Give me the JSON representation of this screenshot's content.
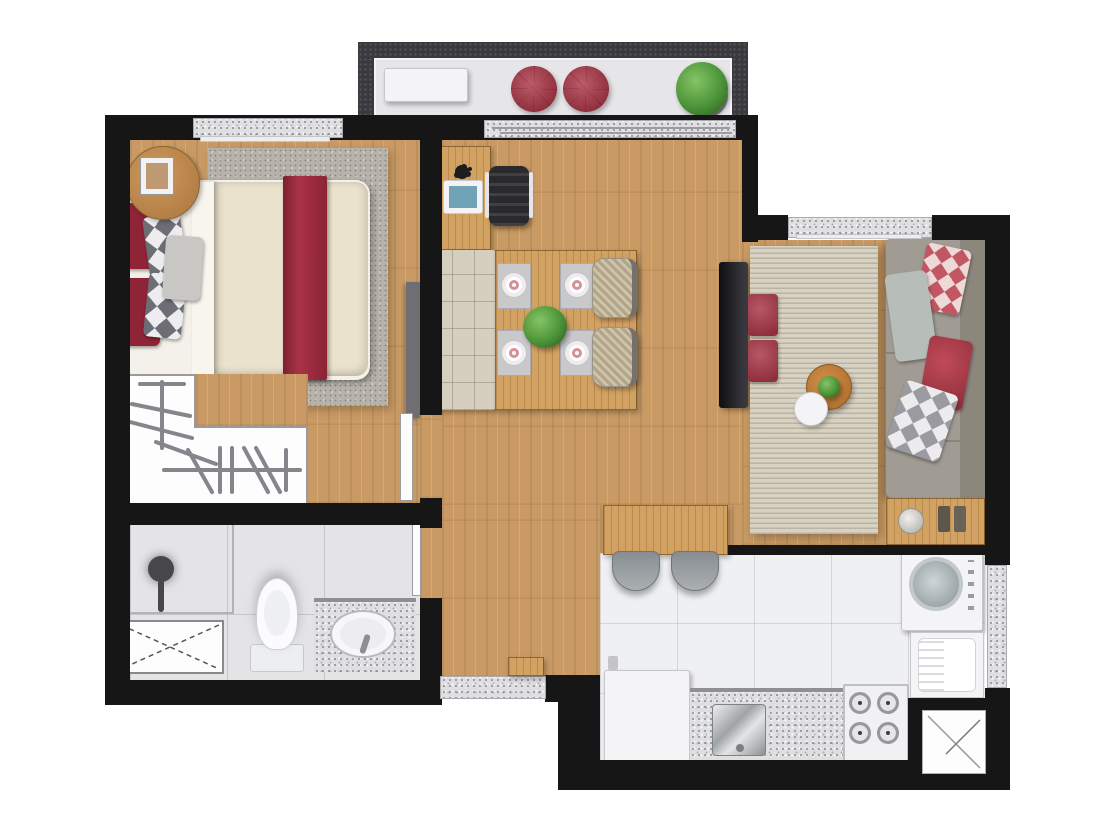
{
  "document_title": "Apartment floor plan — rendered top view",
  "colors": {
    "wall": "#161616",
    "balcony_wall": "#3a3a3e",
    "wood_floor": "#c99a63",
    "wood_furniture": "#d2a263",
    "granite": "#dfdfe2",
    "bath_tile": "#e4e4e7",
    "kitchen_tile": "#eff0f2",
    "bedroom_rug": "#b7b2aa",
    "living_rug": "#d8d2c3",
    "duvet": "#ebe2cd",
    "accent_red": "#9e2b3d",
    "pillow_red": "#8f2436",
    "sofa_gray": "#a19c93",
    "chair_dark": "#2a2a2e",
    "plant_green": "#4c9338",
    "fixture_white": "#f4f4f6",
    "screen_blue": "#6fa3b5"
  },
  "rooms": [
    {
      "id": "balcony",
      "name": "Balcony",
      "furniture": [
        "white bench",
        "red pouf",
        "red pouf",
        "potted plant"
      ]
    },
    {
      "id": "bedroom",
      "name": "Bedroom",
      "furniture": [
        "double bed with red runner",
        "area rug",
        "round nightstand",
        "photo frame",
        "L-shaped wardrobe with hangers",
        "wall shelf"
      ]
    },
    {
      "id": "living_dining",
      "name": "Living / Dining",
      "furniture": [
        "desk with laptop",
        "office chair",
        "upholstered bench",
        "dining table",
        "4 place settings",
        "centerpiece plant",
        "2 wicker chairs",
        "TV panel",
        "bar counter",
        "2 bar stools"
      ]
    },
    {
      "id": "living",
      "name": "Living room",
      "furniture": [
        "striped rug",
        "2 red floor cushions",
        "round coffee table with plant",
        "round side table",
        "gray sofa with 4 pillows",
        "console table with lamp"
      ]
    },
    {
      "id": "bathroom",
      "name": "Bathroom",
      "furniture": [
        "shower with glass screen",
        "toilet",
        "granite vanity with oval sink",
        "crossed service shaft"
      ]
    },
    {
      "id": "kitchen",
      "name": "Kitchen / Laundry",
      "furniture": [
        "refrigerator",
        "granite counter with steel sink",
        "4-burner gas stove",
        "washing machine",
        "laundry tank",
        "service shaft"
      ]
    }
  ],
  "windows": [
    "bedroom window",
    "balcony sliding door",
    "living room window",
    "service area window"
  ],
  "doors": [
    "entrance door",
    "bedroom door",
    "bathroom door"
  ]
}
